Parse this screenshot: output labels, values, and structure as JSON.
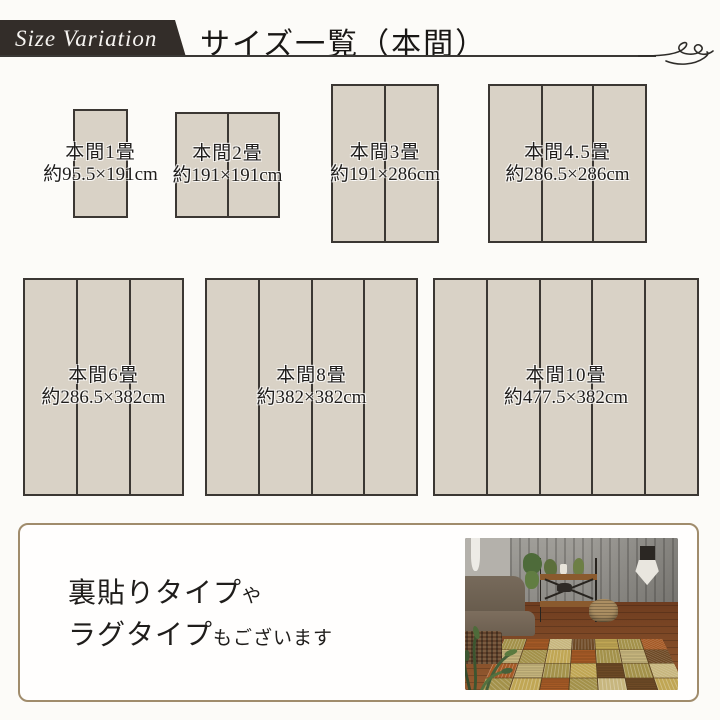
{
  "header": {
    "ribbon_label": "Size Variation",
    "title": "サイズ一覧（本間）"
  },
  "sizes": [
    {
      "name": "本間1畳",
      "dims": "約95.5×191cm",
      "panels": 1
    },
    {
      "name": "本間2畳",
      "dims": "約191×191cm",
      "panels": 2
    },
    {
      "name": "本間3畳",
      "dims": "約191×286cm",
      "panels": 2
    },
    {
      "name": "本間4.5畳",
      "dims": "約286.5×286cm",
      "panels": 3
    },
    {
      "name": "本間6畳",
      "dims": "約286.5×382cm",
      "panels": 3
    },
    {
      "name": "本間8畳",
      "dims": "約382×382cm",
      "panels": 4
    },
    {
      "name": "本間10畳",
      "dims": "約477.5×382cm",
      "panels": 5
    }
  ],
  "note": {
    "line1_main": "裏貼りタイプ",
    "line1_suffix": "や",
    "line2_main": "ラグタイプ",
    "line2_suffix": "もございます"
  },
  "photo": {
    "alt": "ソファとパッチワーク柄ラグを敷いた部屋のイメージ写真"
  },
  "colors": {
    "ribbon": "#332d29",
    "mat_fill": "#d9d2c6",
    "mat_border": "#3b3733",
    "note_border": "#a08c6c",
    "text": "#1f1d1b"
  }
}
